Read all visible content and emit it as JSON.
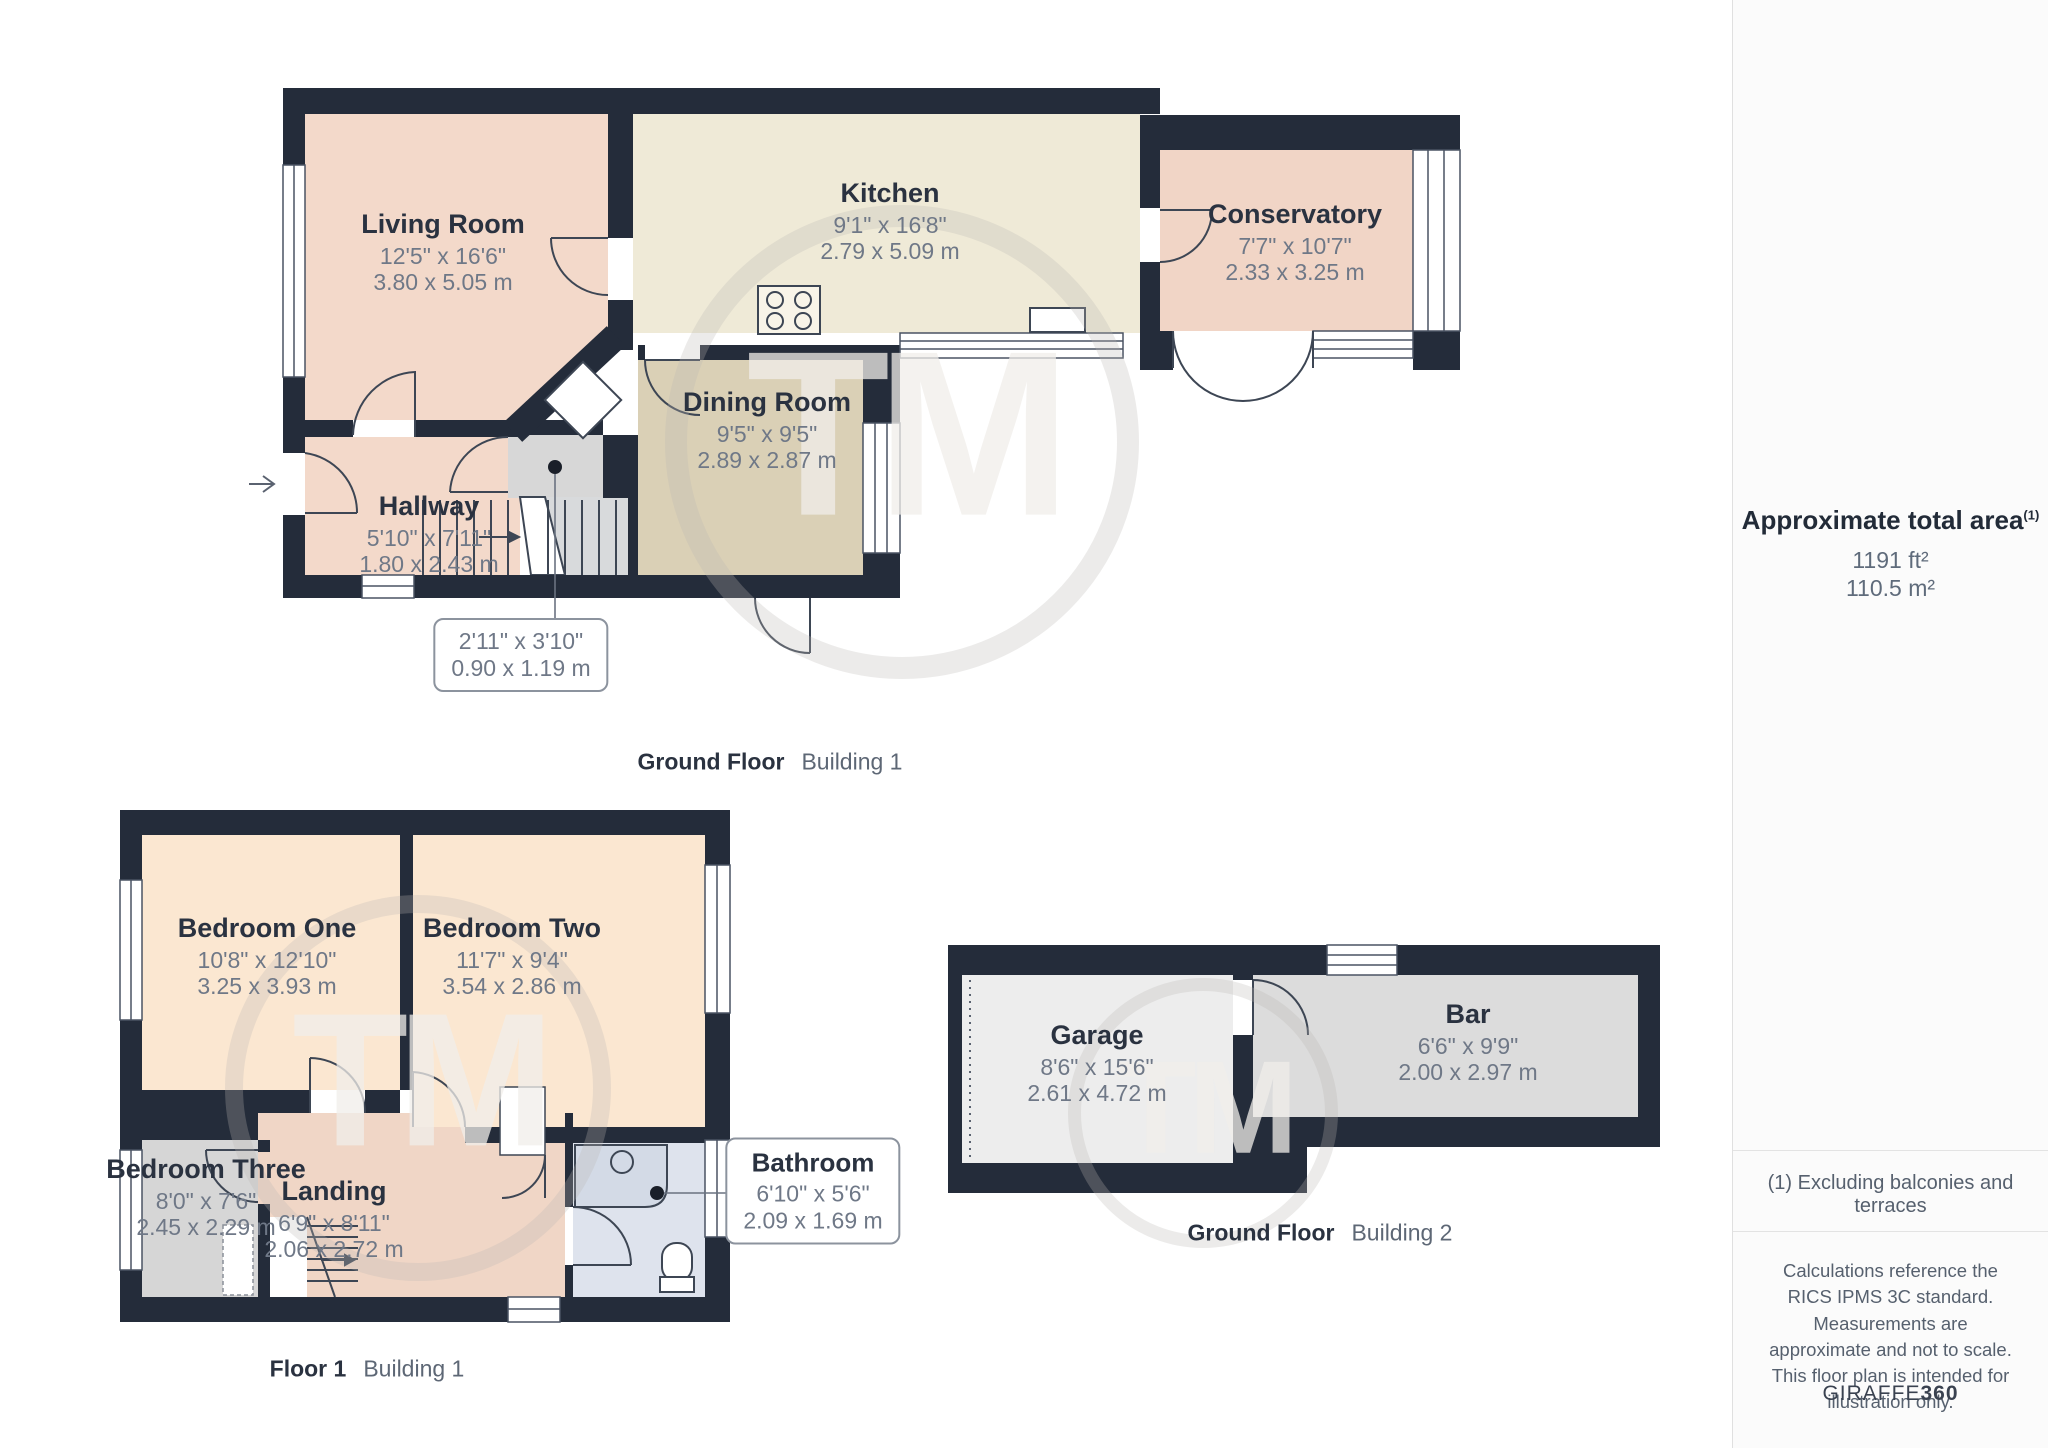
{
  "plans": [
    {
      "floor_label": "Ground Floor",
      "building_label": "Building 1",
      "rooms": [
        {
          "name": "Living Room",
          "imperial": "12'5\" x 16'6\"",
          "metric": "3.80 x 5.05 m"
        },
        {
          "name": "Kitchen",
          "imperial": "9'1\" x 16'8\"",
          "metric": "2.79 x 5.09 m"
        },
        {
          "name": "Conservatory",
          "imperial": "7'7\" x 10'7\"",
          "metric": "2.33 x 3.25 m"
        },
        {
          "name": "Dining Room",
          "imperial": "9'5\" x 9'5\"",
          "metric": "2.89 x 2.87 m"
        },
        {
          "name": "Hallway",
          "imperial": "5'10\" x 7'11\"",
          "metric": "1.80 x 2.43 m"
        }
      ],
      "callout": {
        "imperial": "2'11\" x 3'10\"",
        "metric": "0.90 x 1.19 m"
      }
    },
    {
      "floor_label": "Floor 1",
      "building_label": "Building 1",
      "rooms": [
        {
          "name": "Bedroom One",
          "imperial": "10'8\" x 12'10\"",
          "metric": "3.25 x 3.93 m"
        },
        {
          "name": "Bedroom Two",
          "imperial": "11'7\" x 9'4\"",
          "metric": "3.54 x 2.86 m"
        },
        {
          "name": "Bedroom Three",
          "imperial": "8'0\" x 7'6\"",
          "metric": "2.45 x 2.29 m"
        },
        {
          "name": "Landing",
          "imperial": "6'9\" x 8'11\"",
          "metric": "2.06 x 2.72 m"
        }
      ],
      "callout": {
        "name": "Bathroom",
        "imperial": "6'10\" x 5'6\"",
        "metric": "2.09 x 1.69 m"
      }
    },
    {
      "floor_label": "Ground Floor",
      "building_label": "Building 2",
      "rooms": [
        {
          "name": "Garage",
          "imperial": "8'6\" x 15'6\"",
          "metric": "2.61 x 4.72 m"
        },
        {
          "name": "Bar",
          "imperial": "6'6\" x 9'9\"",
          "metric": "2.00 x 2.97 m"
        }
      ]
    }
  ],
  "sidebar": {
    "title": "Approximate total area",
    "title_footnote": "(1)",
    "area_imperial": "1191 ft²",
    "area_metric": "110.5 m²",
    "note": "(1) Excluding balconies and terraces",
    "disclaimer": "Calculations reference the RICS IPMS 3C standard. Measurements are approximate and not to scale. This floor plan is intended for illustration only.",
    "brand_name": "GIRAFFE",
    "brand_number": "360"
  },
  "watermark": {
    "text": "TM"
  },
  "colors": {
    "wall": "#242C3A",
    "living_pink": "#F3D9CA",
    "kitchen_cream": "#EFEAD7",
    "dining_tan": "#DAD0B6",
    "bedroom_peach": "#FBE7D1",
    "gray_room": "#D6D6D6",
    "bathroom_blue": "#DEE3ED",
    "garage_gray": "#EDEDED",
    "bar_gray": "#DCDCDC",
    "label_dark": "#2A3240",
    "dim_gray": "#6F7887"
  }
}
